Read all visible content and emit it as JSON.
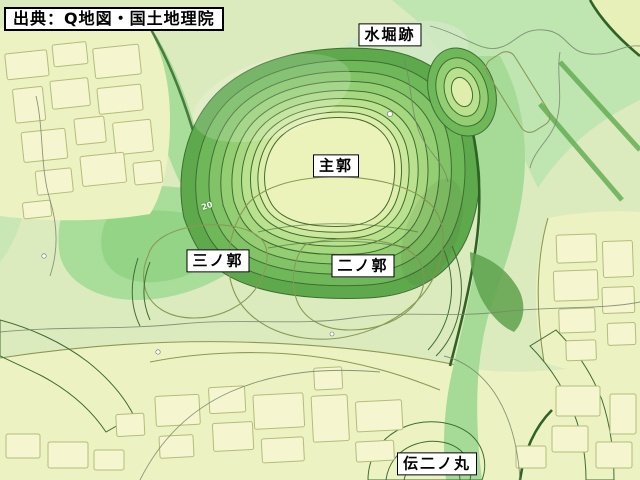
{
  "attribution": {
    "text": "出典：Q地図・国土地理院"
  },
  "map": {
    "kind": "topographic-relief-map",
    "labels": [
      {
        "id": "mizubori-ato",
        "text": "水堀跡"
      },
      {
        "id": "shukaku",
        "text": "主郭"
      },
      {
        "id": "sannokaku",
        "text": "三ノ郭"
      },
      {
        "id": "ninokaku",
        "text": "二ノ郭"
      },
      {
        "id": "den-ninomaru",
        "text": "伝二ノ丸"
      }
    ],
    "contour_elevation_mark": "20"
  },
  "palette": {
    "base": "#dcebbe",
    "plateau": "#edf2c2",
    "plateau_top": "#ecf3ba",
    "ninokaku_tint": "#e7f0b4",
    "sannokaku_tint": "#eaf2b8",
    "block_fill": "#f5f6cf",
    "block_stroke": "#b3bd79",
    "valley_light": "#bfe5b0",
    "valley_mid": "#a6db97",
    "valley_deep": "#8fd281",
    "depression": "#a9dd9a",
    "ridge_green": "#8fcb7e",
    "gully_green": "#9ad489",
    "dark_slope": "#5ea24c",
    "moat_flat": "#cfe9c4",
    "pale_strip": "#e8f0ba",
    "rings": [
      "#5ea94c",
      "#6fb85a",
      "#81c366",
      "#94ce73",
      "#a7d880",
      "#bae18e",
      "#cce89c",
      "#dfeeab",
      "#ecf3ba"
    ],
    "label_bg": "#ffffff",
    "label_border": "#000000",
    "label_text": "#000000"
  }
}
